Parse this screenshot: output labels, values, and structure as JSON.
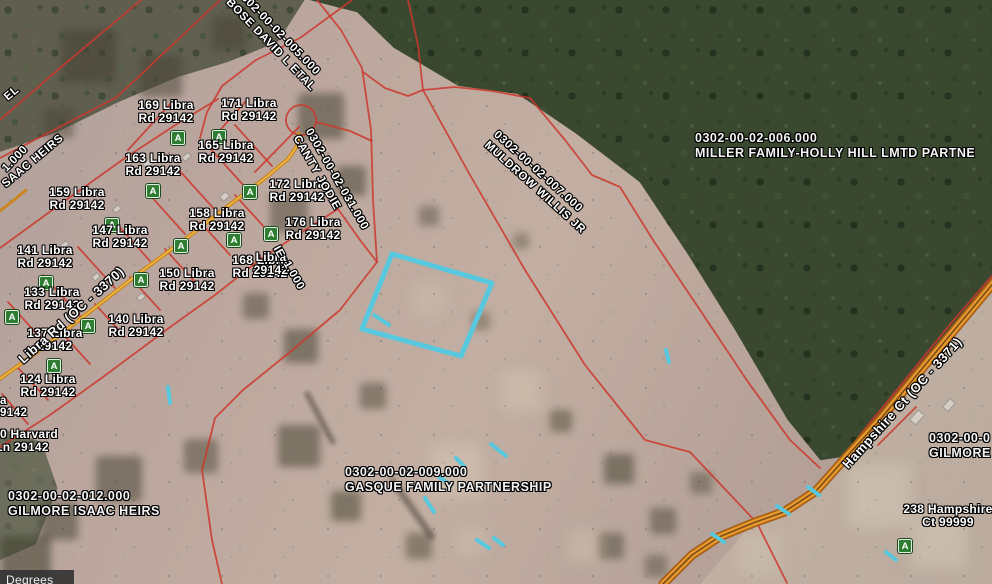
{
  "app": {
    "status_bar_text": "Degrees"
  },
  "colors": {
    "parcel_line": "#cc372b",
    "highlight_cyan": "#57c8de",
    "road_edge": "#a85f17",
    "road_fill": "#e89b2d",
    "road_center": "#7d4a1a",
    "libra_road_outer": "#c9861f",
    "libra_road_inner": "#f0b845",
    "marker_green": "#2e7d32"
  },
  "map": {
    "address_labels": [
      {
        "line1": "169 Libra",
        "line2": "Rd 29142",
        "x": 166,
        "y": 99
      },
      {
        "line1": "171 Libra",
        "line2": "Rd 29142",
        "x": 249,
        "y": 97
      },
      {
        "line1": "163 Libra",
        "line2": "Rd 29142",
        "x": 153,
        "y": 152
      },
      {
        "line1": "165 Libra",
        "line2": "Rd 29142",
        "x": 226,
        "y": 139
      },
      {
        "line1": "159 Libra",
        "line2": "Rd 29142",
        "x": 77,
        "y": 186
      },
      {
        "line1": "147 Libra",
        "line2": "Rd 29142",
        "x": 120,
        "y": 224
      },
      {
        "line1": "158 Libra",
        "line2": "Rd 29142",
        "x": 217,
        "y": 207
      },
      {
        "line1": "141 Libra",
        "line2": "Rd 29142",
        "x": 45,
        "y": 244
      },
      {
        "line1": "168 Libra",
        "line2": "Rd 29142",
        "x": 260,
        "y": 254
      },
      {
        "line1": "150 Libra",
        "line2": "Rd 29142",
        "x": 187,
        "y": 267
      },
      {
        "line1": "133 Libra",
        "line2": "Rd 29142",
        "x": 52,
        "y": 286
      },
      {
        "line1": "140 Libra",
        "line2": "Rd 29142",
        "x": 136,
        "y": 313
      },
      {
        "line1": "137 Libra",
        "line2": "29142",
        "x": 55,
        "y": 327
      },
      {
        "line1": "124 Libra",
        "line2": "Rd 29142",
        "x": 48,
        "y": 373
      },
      {
        "line1": "172 Libra",
        "line2": "Rd 29142",
        "x": 297,
        "y": 178
      },
      {
        "line1": "176 Libra",
        "line2": "Rd 29142",
        "x": 313,
        "y": 216
      },
      {
        "line1": "Libra",
        "line2": "29142",
        "x": 271,
        "y": 251
      },
      {
        "line1": "150 Harvard",
        "line2": "Ln 29142",
        "x": 22,
        "y": 428
      },
      {
        "line1": "238 Hampshire",
        "line2": "Ct 99999",
        "x": 948,
        "y": 503
      }
    ],
    "parcel_id_labels": [
      {
        "line1": "0302-00-02-012.000",
        "line2": "GILMORE ISAAC HEIRS",
        "x": 8,
        "y": 489
      },
      {
        "line1": "0302-00-02-009.000",
        "line2": "GASQUE FAMILY PARTNERSHIP",
        "x": 345,
        "y": 465
      },
      {
        "line1": "0302-00-02-006.000",
        "line2": "MILLER FAMILY-HOLLY HILL LMTD PARTNE",
        "x": 695,
        "y": 131
      },
      {
        "line1": "0302-00-0",
        "line2": "GILMORE",
        "x": 929,
        "y": 431
      }
    ],
    "rotated_labels": [
      {
        "lines": [
          "0302-00-02-005.000",
          "BOSE DAVID L ETAL"
        ],
        "x": 243,
        "y": -14,
        "angle": 46,
        "size": 11.5
      },
      {
        "lines": [
          "0302-00-02-031.000",
          "CANTY JODIE"
        ],
        "x": 314,
        "y": 126,
        "angle": 60,
        "size": 11.5
      },
      {
        "lines": [
          "0302-00-02-007.000",
          "MULDROW WILLIS JR"
        ],
        "x": 500,
        "y": 128,
        "angle": 42,
        "size": 11.5
      },
      {
        "lines": [
          "Libra Rd (OC - 3370)"
        ],
        "x": 16,
        "y": 356,
        "angle": -42,
        "size": 13
      },
      {
        "lines": [
          "Hampshire Ct (OC - 3371)"
        ],
        "x": 840,
        "y": 462,
        "angle": -48,
        "size": 13
      }
    ],
    "text_fragments": [
      {
        "text": "EL",
        "x": 2,
        "y": 94,
        "angle": -40
      },
      {
        "text": "1.000",
        "x": 0,
        "y": 166,
        "angle": -46
      },
      {
        "text": "SAAC HEIRS",
        "x": 0,
        "y": 181,
        "angle": -40
      },
      {
        "text": "IE",
        "x": 281,
        "y": 244,
        "angle": 60
      },
      {
        "text": "1.000",
        "x": 291,
        "y": 259,
        "angle": 60
      },
      {
        "text": "a",
        "x": 0,
        "y": 395,
        "angle": 0
      },
      {
        "text": "9142",
        "x": 0,
        "y": 407,
        "angle": 0
      }
    ],
    "markers": [
      {
        "x": 178,
        "y": 138
      },
      {
        "x": 219,
        "y": 137
      },
      {
        "x": 153,
        "y": 191
      },
      {
        "x": 112,
        "y": 225
      },
      {
        "x": 181,
        "y": 246
      },
      {
        "x": 234,
        "y": 240
      },
      {
        "x": 271,
        "y": 234
      },
      {
        "x": 141,
        "y": 280
      },
      {
        "x": 46,
        "y": 283
      },
      {
        "x": 12,
        "y": 317
      },
      {
        "x": 88,
        "y": 326
      },
      {
        "x": 54,
        "y": 366
      },
      {
        "x": 250,
        "y": 192
      },
      {
        "x": 905,
        "y": 546
      }
    ],
    "selection": {
      "polygon": [
        [
          392,
          254
        ],
        [
          492,
          283
        ],
        [
          461,
          356
        ],
        [
          362,
          329
        ]
      ],
      "dashes": [
        [
          [
            374,
            315
          ],
          [
            389,
            325
          ]
        ],
        [
          [
            168,
            387
          ],
          [
            170,
            403
          ]
        ],
        [
          [
            491,
            444
          ],
          [
            506,
            456
          ]
        ],
        [
          [
            456,
            458
          ],
          [
            464,
            466
          ]
        ],
        [
          [
            439,
            477
          ],
          [
            451,
            485
          ]
        ],
        [
          [
            425,
            498
          ],
          [
            434,
            512
          ]
        ],
        [
          [
            477,
            540
          ],
          [
            489,
            548
          ]
        ],
        [
          [
            494,
            538
          ],
          [
            503,
            545
          ]
        ],
        [
          [
            808,
            487
          ],
          [
            819,
            495
          ]
        ],
        [
          [
            777,
            506
          ],
          [
            789,
            514
          ]
        ],
        [
          [
            712,
            534
          ],
          [
            724,
            542
          ]
        ],
        [
          [
            666,
            350
          ],
          [
            669,
            362
          ]
        ],
        [
          [
            886,
            552
          ],
          [
            896,
            560
          ]
        ]
      ]
    },
    "geometry": {
      "red_lines": [
        [
          [
            220,
            0
          ],
          [
            117,
            97
          ],
          [
            0,
            158
          ]
        ],
        [
          [
            141,
            0
          ],
          [
            60,
            68
          ],
          [
            0,
            120
          ]
        ],
        [
          [
            352,
            0
          ],
          [
            300,
            38
          ],
          [
            256,
            60
          ],
          [
            222,
            86
          ],
          [
            207,
            112
          ],
          [
            200,
            138
          ]
        ],
        [
          [
            317,
            0
          ],
          [
            341,
            30
          ],
          [
            362,
            68
          ],
          [
            371,
            130
          ],
          [
            373,
            200
          ],
          [
            377,
            262
          ],
          [
            340,
            310
          ],
          [
            290,
            352
          ],
          [
            243,
            390
          ],
          [
            215,
            418
          ],
          [
            202,
            470
          ],
          [
            212,
            540
          ],
          [
            222,
            584
          ]
        ],
        [
          [
            316,
            122
          ],
          [
            350,
            131
          ],
          [
            372,
            141
          ]
        ],
        [
          [
            0,
            248
          ],
          [
            62,
            203
          ],
          [
            125,
            158
          ],
          [
            180,
            122
          ],
          [
            218,
            99
          ]
        ],
        [
          [
            0,
            447
          ],
          [
            50,
            415
          ],
          [
            103,
            377
          ],
          [
            173,
            325
          ],
          [
            215,
            295
          ],
          [
            262,
            258
          ],
          [
            305,
            230
          ],
          [
            338,
            209
          ]
        ],
        [
          [
            363,
            72
          ],
          [
            385,
            88
          ],
          [
            408,
            96
          ],
          [
            423,
            90
          ],
          [
            455,
            87
          ],
          [
            492,
            91
          ],
          [
            530,
            98
          ],
          [
            565,
            140
          ],
          [
            592,
            175
          ],
          [
            620,
            187
          ],
          [
            653,
            240
          ],
          [
            700,
            310
          ],
          [
            748,
            382
          ],
          [
            790,
            440
          ],
          [
            820,
            468
          ]
        ],
        [
          [
            408,
            0
          ],
          [
            418,
            45
          ],
          [
            423,
            90
          ]
        ],
        [
          [
            423,
            90
          ],
          [
            470,
            175
          ],
          [
            525,
            270
          ],
          [
            585,
            365
          ],
          [
            645,
            440
          ],
          [
            690,
            452
          ],
          [
            757,
            523
          ],
          [
            787,
            583
          ]
        ],
        [
          [
            992,
            276
          ],
          [
            952,
            322
          ],
          [
            905,
            380
          ],
          [
            868,
            425
          ],
          [
            846,
            453
          ]
        ],
        [
          [
            878,
            445
          ],
          [
            898,
            425
          ],
          [
            916,
            407
          ]
        ],
        [
          [
            45,
            343
          ],
          [
            8,
            302
          ]
        ],
        [
          [
            80,
            316
          ],
          [
            43,
            275
          ]
        ],
        [
          [
            115,
            288
          ],
          [
            78,
            247
          ]
        ],
        [
          [
            150,
            261
          ],
          [
            113,
            220
          ]
        ],
        [
          [
            185,
            234
          ],
          [
            148,
            193
          ]
        ],
        [
          [
            215,
            210
          ],
          [
            178,
            169
          ]
        ],
        [
          [
            245,
            187
          ],
          [
            208,
            146
          ]
        ],
        [
          [
            272,
            166
          ],
          [
            235,
            125
          ]
        ],
        [
          [
            60,
            331
          ],
          [
            90,
            364
          ]
        ],
        [
          [
            95,
            304
          ],
          [
            125,
            337
          ]
        ],
        [
          [
            130,
            277
          ],
          [
            160,
            310
          ]
        ],
        [
          [
            165,
            249
          ],
          [
            195,
            282
          ]
        ],
        [
          [
            200,
            222
          ],
          [
            230,
            255
          ]
        ],
        [
          [
            235,
            195
          ],
          [
            265,
            228
          ]
        ],
        [
          [
            128,
            150
          ],
          [
            172,
            102
          ]
        ],
        [
          [
            205,
            147
          ],
          [
            247,
            100
          ]
        ],
        [
          [
            255,
            172
          ],
          [
            299,
            127
          ]
        ],
        [
          [
            338,
            209
          ],
          [
            360,
            240
          ],
          [
            377,
            262
          ]
        ],
        [
          [
            18,
            368
          ],
          [
            48,
            400
          ]
        ],
        [
          [
            2,
            394
          ],
          [
            28,
            424
          ]
        ]
      ],
      "cul_de_sac": {
        "cx": 301,
        "cy": 120,
        "r": 15
      },
      "roads": {
        "libra": [
          [
            -6,
            383
          ],
          [
            40,
            350
          ],
          [
            92,
            310
          ],
          [
            142,
            271
          ],
          [
            192,
            234
          ],
          [
            232,
            203
          ],
          [
            264,
            179
          ],
          [
            288,
            159
          ],
          [
            297,
            146
          ],
          [
            299,
            134
          ]
        ],
        "libra_stub": [
          [
            -4,
            214
          ],
          [
            14,
            200
          ],
          [
            26,
            190
          ]
        ],
        "hampshire": [
          [
            996,
            280
          ],
          [
            956,
            328
          ],
          [
            916,
            376
          ],
          [
            879,
            421
          ],
          [
            849,
            454
          ],
          [
            816,
            491
          ],
          [
            784,
            512
          ],
          [
            753,
            523
          ],
          [
            719,
            537
          ],
          [
            692,
            555
          ],
          [
            663,
            584
          ]
        ]
      }
    },
    "houses": [
      {
        "x": 148,
        "y": 163,
        "w": 10,
        "h": 7,
        "a": -40
      },
      {
        "x": 186,
        "y": 157,
        "w": 9,
        "h": 6,
        "a": -40
      },
      {
        "x": 224,
        "y": 196,
        "w": 9,
        "h": 7,
        "a": -40
      },
      {
        "x": 117,
        "y": 209,
        "w": 8,
        "h": 6,
        "a": -40
      },
      {
        "x": 64,
        "y": 245,
        "w": 9,
        "h": 6,
        "a": -40
      },
      {
        "x": 96,
        "y": 277,
        "w": 8,
        "h": 6,
        "a": -40
      },
      {
        "x": 141,
        "y": 297,
        "w": 8,
        "h": 6,
        "a": -40
      },
      {
        "x": 40,
        "y": 262,
        "w": 8,
        "h": 6,
        "a": -40
      },
      {
        "x": 917,
        "y": 417,
        "w": 14,
        "h": 9,
        "a": -48
      },
      {
        "x": 949,
        "y": 405,
        "w": 12,
        "h": 8,
        "a": -48
      },
      {
        "x": 879,
        "y": 429,
        "w": 9,
        "h": 7,
        "a": -48
      }
    ]
  }
}
